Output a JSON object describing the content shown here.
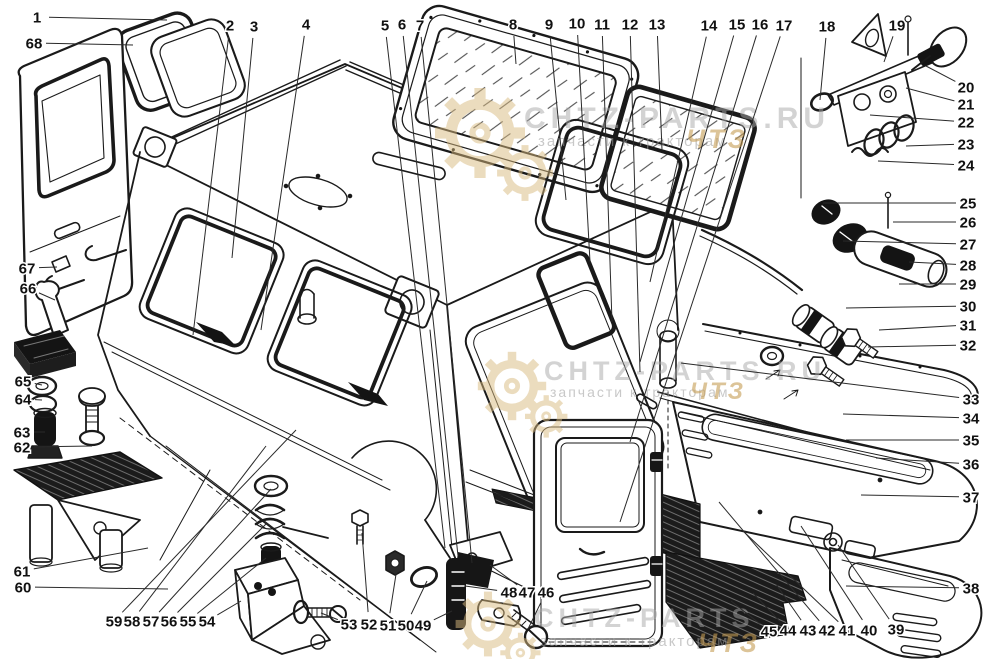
{
  "page": {
    "background_color": "#ffffff",
    "line_color": "#1a1a1a",
    "description_numbers_color": "#111111"
  },
  "watermark": {
    "tagline": "запчасти к тракторам",
    "tagline_suffix": "ЧТЗ",
    "brand_color": "#a9a9a9",
    "accent_color": "#c69d55",
    "instances": [
      {
        "brand": "CHTZ-PARTS.RU",
        "gx": 480,
        "gy": 133,
        "gs": 1.25,
        "bx": 524,
        "by": 128,
        "bsize": 30,
        "tagx": 538,
        "tagy": 146,
        "tsize": 15,
        "sx": 686,
        "sy": 148,
        "ssize": 27
      },
      {
        "brand": "CHTZ-PARTS.RU",
        "gx": 512,
        "gy": 386,
        "gs": 0.95,
        "bx": 544,
        "by": 380,
        "bsize": 27,
        "tagx": 550,
        "tagy": 397,
        "tsize": 14,
        "sx": 690,
        "sy": 399,
        "ssize": 24
      },
      {
        "brand": "CHTZ-PARTS",
        "gx": 488,
        "gy": 624,
        "gs": 0.9,
        "bx": 534,
        "by": 627,
        "bsize": 27,
        "tagx": 540,
        "tagy": 646,
        "tsize": 15,
        "sx": 698,
        "sy": 652,
        "ssize": 27
      }
    ]
  },
  "callouts": [
    {
      "n": "1",
      "x": 37,
      "y": 17,
      "tx": 167,
      "ty": 20
    },
    {
      "n": "2",
      "x": 230,
      "y": 25,
      "tx": 193,
      "ty": 335
    },
    {
      "n": "3",
      "x": 254,
      "y": 26,
      "tx": 232,
      "ty": 258
    },
    {
      "n": "4",
      "x": 306,
      "y": 24,
      "tx": 261,
      "ty": 330
    },
    {
      "n": "5",
      "x": 385,
      "y": 25,
      "tx": 445,
      "ty": 548
    },
    {
      "n": "6",
      "x": 402,
      "y": 24,
      "tx": 458,
      "ty": 556
    },
    {
      "n": "7",
      "x": 420,
      "y": 25,
      "tx": 472,
      "ty": 563
    },
    {
      "n": "8",
      "x": 513,
      "y": 24,
      "tx": 516,
      "ty": 64
    },
    {
      "n": "9",
      "x": 549,
      "y": 24,
      "tx": 566,
      "ty": 200
    },
    {
      "n": "10",
      "x": 577,
      "y": 23,
      "tx": 590,
      "ty": 262
    },
    {
      "n": "11",
      "x": 602,
      "y": 24,
      "tx": 612,
      "ty": 322
    },
    {
      "n": "12",
      "x": 630,
      "y": 24,
      "tx": 640,
      "ty": 372
    },
    {
      "n": "13",
      "x": 657,
      "y": 24,
      "tx": 662,
      "ty": 150
    },
    {
      "n": "14",
      "x": 709,
      "y": 25,
      "tx": 650,
      "ty": 282
    },
    {
      "n": "15",
      "x": 737,
      "y": 24,
      "tx": 640,
      "ty": 362
    },
    {
      "n": "16",
      "x": 760,
      "y": 24,
      "tx": 630,
      "ty": 442
    },
    {
      "n": "17",
      "x": 784,
      "y": 25,
      "tx": 620,
      "ty": 522
    },
    {
      "n": "18",
      "x": 827,
      "y": 26,
      "tx": 820,
      "ty": 100
    },
    {
      "n": "19",
      "x": 897,
      "y": 25,
      "tx": 884,
      "ty": 62
    },
    {
      "n": "20",
      "x": 966,
      "y": 87,
      "tx": 926,
      "ty": 66
    },
    {
      "n": "21",
      "x": 966,
      "y": 104,
      "tx": 906,
      "ty": 88
    },
    {
      "n": "22",
      "x": 966,
      "y": 122,
      "tx": 870,
      "ty": 115
    },
    {
      "n": "23",
      "x": 966,
      "y": 144,
      "tx": 906,
      "ty": 146
    },
    {
      "n": "24",
      "x": 966,
      "y": 165,
      "tx": 878,
      "ty": 161
    },
    {
      "n": "25",
      "x": 968,
      "y": 203,
      "tx": 823,
      "ty": 203
    },
    {
      "n": "26",
      "x": 968,
      "y": 222,
      "tx": 893,
      "ty": 222
    },
    {
      "n": "27",
      "x": 968,
      "y": 244,
      "tx": 843,
      "ty": 241
    },
    {
      "n": "28",
      "x": 968,
      "y": 265,
      "tx": 909,
      "ty": 262
    },
    {
      "n": "29",
      "x": 968,
      "y": 284,
      "tx": 899,
      "ty": 284
    },
    {
      "n": "30",
      "x": 968,
      "y": 306,
      "tx": 846,
      "ty": 308
    },
    {
      "n": "31",
      "x": 968,
      "y": 325,
      "tx": 879,
      "ty": 330
    },
    {
      "n": "32",
      "x": 968,
      "y": 345,
      "tx": 868,
      "ty": 347
    },
    {
      "n": "33",
      "x": 971,
      "y": 399,
      "tx": 681,
      "ty": 363
    },
    {
      "n": "34",
      "x": 971,
      "y": 418,
      "tx": 843,
      "ty": 414
    },
    {
      "n": "35",
      "x": 971,
      "y": 440,
      "tx": 846,
      "ty": 440
    },
    {
      "n": "36",
      "x": 971,
      "y": 464,
      "tx": 876,
      "ty": 458
    },
    {
      "n": "37",
      "x": 971,
      "y": 497,
      "tx": 861,
      "ty": 495
    },
    {
      "n": "38",
      "x": 971,
      "y": 588,
      "tx": 846,
      "ty": 586
    },
    {
      "n": "39",
      "x": 896,
      "y": 629,
      "tx": 838,
      "ty": 545
    },
    {
      "n": "40",
      "x": 869,
      "y": 630,
      "tx": 801,
      "ty": 526
    },
    {
      "n": "41",
      "x": 847,
      "y": 630,
      "tx": 742,
      "ty": 530
    },
    {
      "n": "42",
      "x": 827,
      "y": 630,
      "tx": 719,
      "ty": 502
    },
    {
      "n": "43",
      "x": 808,
      "y": 630,
      "tx": 776,
      "ty": 584
    },
    {
      "n": "44",
      "x": 788,
      "y": 630,
      "tx": 753,
      "ty": 593
    },
    {
      "n": "45",
      "x": 769,
      "y": 631,
      "tx": 731,
      "ty": 601
    },
    {
      "n": "46",
      "x": 546,
      "y": 592,
      "tx": 528,
      "ty": 629
    },
    {
      "n": "47",
      "x": 527,
      "y": 592,
      "tx": 490,
      "ty": 565
    },
    {
      "n": "48",
      "x": 509,
      "y": 592,
      "tx": 465,
      "ty": 586
    },
    {
      "n": "49",
      "x": 423,
      "y": 625,
      "tx": 452,
      "ty": 611
    },
    {
      "n": "50",
      "x": 406,
      "y": 625,
      "tx": 427,
      "ty": 581
    },
    {
      "n": "51",
      "x": 388,
      "y": 625,
      "tx": 397,
      "ty": 568
    },
    {
      "n": "52",
      "x": 369,
      "y": 624,
      "tx": 362,
      "ty": 533
    },
    {
      "n": "53",
      "x": 349,
      "y": 624,
      "tx": 321,
      "ty": 613
    },
    {
      "n": "54",
      "x": 207,
      "y": 621,
      "tx": 241,
      "ty": 601
    },
    {
      "n": "55",
      "x": 188,
      "y": 621,
      "tx": 266,
      "ty": 558
    },
    {
      "n": "56",
      "x": 169,
      "y": 621,
      "tx": 267,
      "ty": 523
    },
    {
      "n": "57",
      "x": 151,
      "y": 621,
      "tx": 271,
      "ty": 489
    },
    {
      "n": "58",
      "x": 132,
      "y": 621,
      "tx": 266,
      "ty": 446
    },
    {
      "n": "59",
      "x": 114,
      "y": 621,
      "tx": 296,
      "ty": 430
    },
    {
      "n": "60",
      "x": 23,
      "y": 587,
      "tx": 168,
      "ty": 589
    },
    {
      "n": "61",
      "x": 22,
      "y": 571,
      "tx": 148,
      "ty": 548
    },
    {
      "n": "62",
      "x": 22,
      "y": 447,
      "tx": 92,
      "ty": 446
    },
    {
      "n": "63",
      "x": 22,
      "y": 432,
      "tx": 45,
      "ty": 432
    },
    {
      "n": "64",
      "x": 23,
      "y": 399,
      "tx": 42,
      "ty": 400
    },
    {
      "n": "65",
      "x": 23,
      "y": 381,
      "tx": 42,
      "ty": 385
    },
    {
      "n": "66",
      "x": 28,
      "y": 288,
      "tx": 55,
      "ty": 300
    },
    {
      "n": "67",
      "x": 27,
      "y": 268,
      "tx": 57,
      "ty": 267
    },
    {
      "n": "68",
      "x": 34,
      "y": 43,
      "tx": 133,
      "ty": 45
    }
  ]
}
